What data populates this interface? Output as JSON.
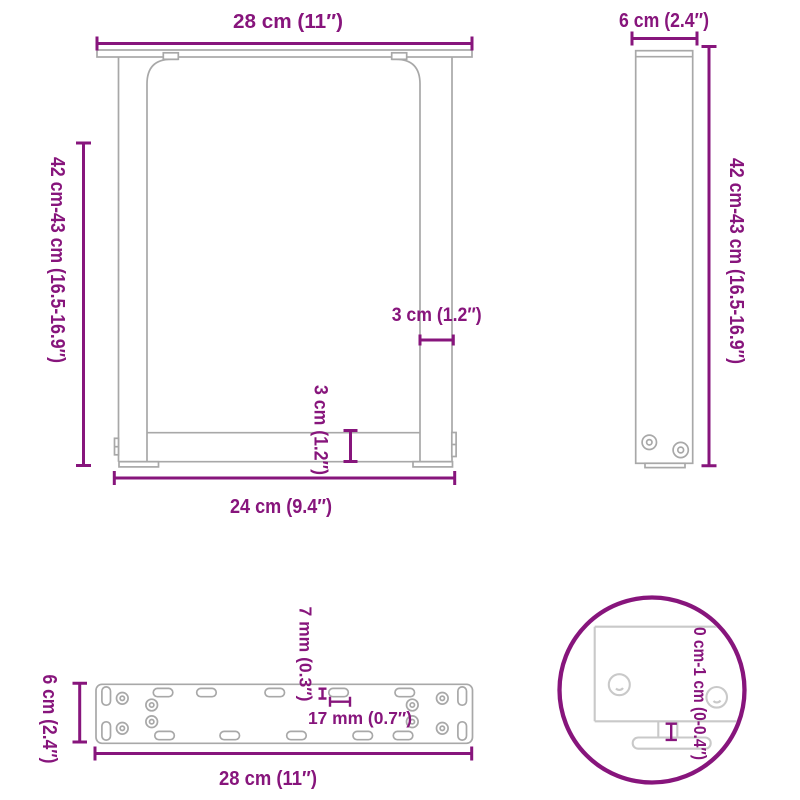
{
  "palette": {
    "dimension_color": "#87157c",
    "outline_color": "#a8a8a8",
    "outline_light_color": "#c9c9c9",
    "background": "#ffffff"
  },
  "diagram": {
    "front_view": {
      "top_width": "28 cm (11″)",
      "height": "42 cm-43 cm (16.5-16.9″)",
      "leg_thickness": "3 cm (1.2″)",
      "crossbar_thickness": "3 cm (1.2″)",
      "bottom_width": "24 cm (9.4″)"
    },
    "side_view": {
      "depth": "6 cm (2.4″)",
      "height": "42 cm-43 cm (16.5-16.9″)"
    },
    "plate_view": {
      "depth": "6 cm (2.4″)",
      "length": "28 cm (11″)",
      "slot_width": "7 mm (0.3″)",
      "slot_length": "17 mm (0.7″)"
    },
    "detail_view": {
      "adjustable_range": "0 cm-1 cm (0-0.4″)"
    }
  }
}
